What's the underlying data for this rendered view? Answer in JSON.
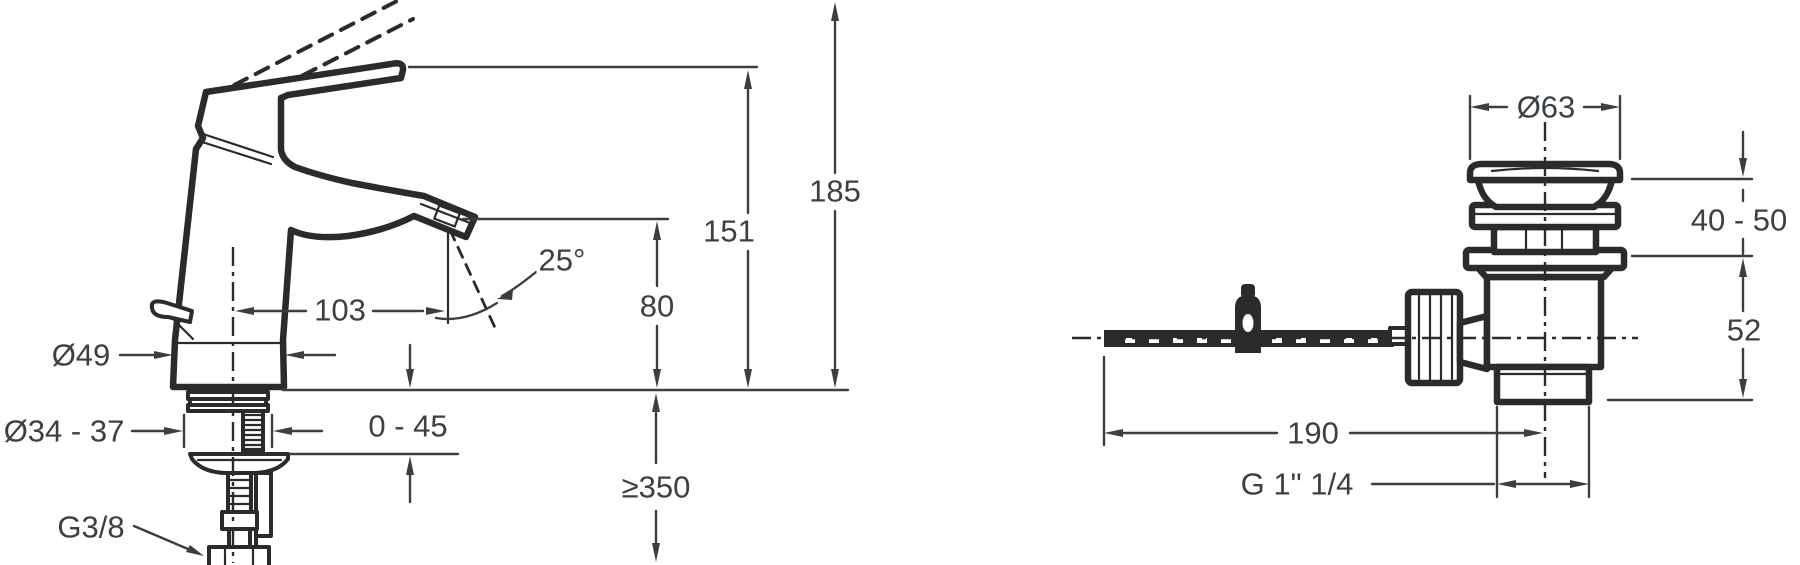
{
  "diagram": {
    "title": "basin mixer and pop-up waste dimension drawing",
    "units": "mm",
    "colors": {
      "line": "#2b2b2b",
      "dimension": "#3a3f44",
      "background": "#ffffff"
    },
    "faucet_view": {
      "dims": {
        "total_height": "185",
        "handle_height": "151",
        "spout_height": "80",
        "spout_reach": "103",
        "spray_angle": "25°",
        "base_diameter": "Ø49",
        "hole_diameter": "Ø34 - 37",
        "deck_thickness": "0 - 45",
        "min_clearance": "≥350",
        "supply_thread": "G3/8"
      }
    },
    "drain_view": {
      "dims": {
        "flange_diameter": "Ø63",
        "plug_range": "40 - 50",
        "body_height": "52",
        "rod_length": "190",
        "outlet_thread": "G 1\" 1/4"
      }
    }
  }
}
